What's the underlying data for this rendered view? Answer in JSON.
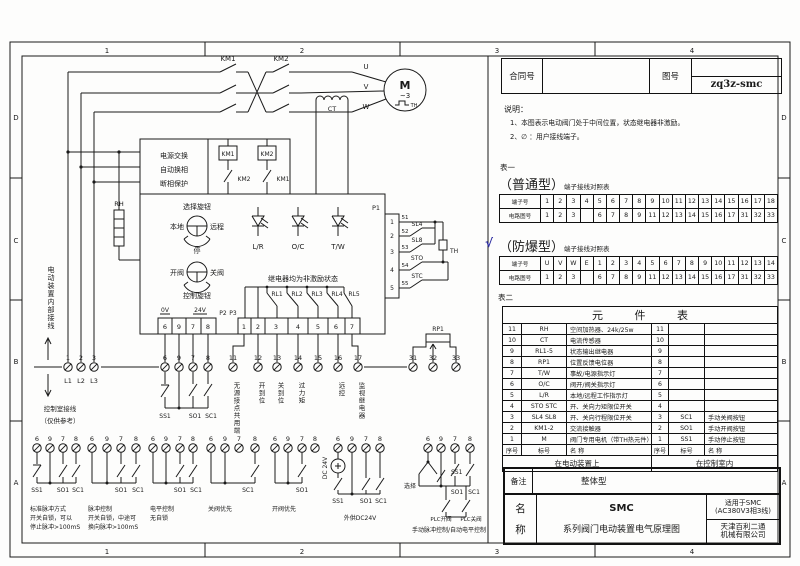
{
  "frame": {
    "top": [
      "1",
      "2",
      "3",
      "4"
    ],
    "bottom": [
      "1",
      "2",
      "3",
      "4"
    ],
    "left": [
      "D",
      "C",
      "B",
      "A"
    ],
    "right": [
      "D",
      "C",
      "B",
      "A"
    ]
  },
  "header": {
    "contract_label": "合同号",
    "drawing_label": "图号",
    "drawing_no": "zq3z-smc"
  },
  "notes": {
    "title": "说明：",
    "line1": "1、本图表示电动阀门处于中间位置，状态继电器非激励。",
    "line2": "2、∅ ：用户接线端子。"
  },
  "table1": {
    "caption": "表一",
    "putong_title": "（普通型）",
    "putong_sub": "端子接线对照表",
    "putong_rows": [
      [
        "端子号",
        "1",
        "2",
        "3",
        "4",
        "5",
        "6",
        "7",
        "8",
        "9",
        "10",
        "11",
        "12",
        "13",
        "14",
        "15",
        "16",
        "17",
        "18"
      ],
      [
        "电路图号",
        "1",
        "2",
        "3",
        "",
        "6",
        "7",
        "8",
        "9",
        "11",
        "12",
        "13",
        "14",
        "15",
        "16",
        "17",
        "31",
        "32",
        "33"
      ]
    ],
    "fangbao_check": "√",
    "fangbao_title": "（防爆型）",
    "fangbao_sub": "端子接线对照表",
    "fangbao_rows": [
      [
        "端子号",
        "U",
        "V",
        "W",
        "E",
        "1",
        "2",
        "3",
        "4",
        "5",
        "6",
        "7",
        "8",
        "9",
        "10",
        "11",
        "12",
        "13",
        "14"
      ],
      [
        "电路图号",
        "1",
        "2",
        "3",
        "",
        "6",
        "7",
        "8",
        "9",
        "11",
        "12",
        "13",
        "14",
        "15",
        "16",
        "17",
        "31",
        "32",
        "33"
      ]
    ]
  },
  "table2": {
    "caption": "表二",
    "title": "元 件 表",
    "rows": [
      [
        "11",
        "RH",
        "空间加热器、24k/25w",
        "11",
        "",
        ""
      ],
      [
        "10",
        "CT",
        "电流传感器",
        "10",
        "",
        ""
      ],
      [
        "9",
        "RL1-5",
        "状态输出继电器",
        "9",
        "",
        ""
      ],
      [
        "8",
        "RP1",
        "位置反馈电位器",
        "8",
        "",
        ""
      ],
      [
        "7",
        "T/W",
        "事故/电源指示灯",
        "7",
        "",
        ""
      ],
      [
        "6",
        "O/C",
        "阀开/阀关指示灯",
        "6",
        "",
        ""
      ],
      [
        "5",
        "L/R",
        "本地/远程工作指示灯",
        "5",
        "",
        ""
      ],
      [
        "4",
        "STO STC",
        "开、关向力矩限位开关",
        "4",
        "",
        ""
      ],
      [
        "3",
        "SL4 SL8",
        "开、关向行程限位开关",
        "3",
        "SC1",
        "手动关阀按钮"
      ],
      [
        "2",
        "KM1-2",
        "交流接触器",
        "2",
        "SO1",
        "手动开阀按钮"
      ],
      [
        "1",
        "M",
        "阀门专用电机（带TH热元件）",
        "1",
        "SS1",
        "手动停止按钮"
      ],
      [
        "序号",
        "标号",
        "名  称",
        "序号",
        "标号",
        "名  称"
      ]
    ],
    "footer_left": "在电动装置上",
    "footer_right": "在控制室内"
  },
  "remark": {
    "label": "备注",
    "value": "整体型"
  },
  "titleblock": {
    "name_label_1": "名",
    "name_label_2": "称",
    "product": "SMC",
    "product_desc": "系列阀门电动装置电气原理图",
    "apply_1": "适用于SMC",
    "apply_2": "(AC380V3相3线)",
    "company_1": "天津百利二通",
    "company_2": "机械有限公司"
  },
  "schematic": {
    "km1_top": "KM1",
    "km2_top": "KM2",
    "phase_u": "U",
    "phase_v": "V",
    "phase_w": "W",
    "motor_label": "M",
    "motor_phase": "~3",
    "motor_th": "TH",
    "ct": "CT",
    "power_box1": "电源交换",
    "power_box2": "自动换相",
    "power_box3": "断相保护",
    "km1_coil": "KM1",
    "km2_coil": "KM2",
    "km2_nc": "KM2",
    "km1_nc": "KM1",
    "rh": "RH",
    "sel_knob": "选择旋钮",
    "local": "本地",
    "remote": "远程",
    "stop": "停",
    "open": "开阀",
    "close": "关阀",
    "ctrl_knob": "控制旋钮",
    "lamps": [
      "L/R",
      "O/C",
      "T/W"
    ],
    "relay_note": "继电器均为非激励状态",
    "relays": [
      "RL1",
      "RL2",
      "RL3",
      "RL4",
      "RL5"
    ],
    "p2": "P2",
    "p3": "P3",
    "p1": "P1",
    "rp1": "RP1",
    "v0": "0V",
    "v24": "24V",
    "p2_cells": [
      "6",
      "9",
      "7",
      "8"
    ],
    "p3_cells": [
      "1",
      "2",
      "3",
      "4",
      "5",
      "6",
      "7"
    ],
    "p1_pins": [
      "1",
      "2",
      "3",
      "4",
      "5"
    ],
    "wire_nums": [
      "51",
      "52",
      "53",
      "54",
      "55"
    ],
    "sl4": "SL4",
    "sl8": "SL8",
    "sto": "STO",
    "stc": "STC",
    "th": "TH",
    "left_note_inner": "电动装置内部接线",
    "left_note_ctrl": "控制室接线",
    "left_note_ref": "（仅供参考）",
    "l_terms": [
      "1",
      "2",
      "3"
    ],
    "l_labels": [
      "L1",
      "L2",
      "L3"
    ],
    "btn_terms": [
      "6",
      "9",
      "7",
      "8"
    ],
    "btn_labels": [
      "SS1",
      "SO1",
      "SC1"
    ],
    "mid_terms": [
      "11",
      "12",
      "13",
      "14",
      "15",
      "16",
      "17"
    ],
    "mid_labels": [
      "无源接点共用端",
      "开到位",
      "关到位",
      "过力矩",
      "远控",
      "监视继电器"
    ],
    "pot_terms": [
      "31",
      "32",
      "33"
    ],
    "g_terms": [
      "6",
      "9",
      "7",
      "8"
    ],
    "g1": {
      "b1": "SS1",
      "b2": "SO1",
      "b3": "SC1",
      "c1": "标准脉冲方式",
      "c2": "开关自锁，可以",
      "c3": "停止脉冲>100mS"
    },
    "g2": {
      "b1": "SO1",
      "b2": "SC1",
      "c1": "脉冲控制",
      "c2": "开关自锁，中途可",
      "c3": "换向脉冲>100mS"
    },
    "g3": {
      "b1": "SO1",
      "b2": "SC1",
      "c1": "电平控制",
      "c2": "无自锁"
    },
    "g4": {
      "b1": "SC1",
      "c1": "关阀优先"
    },
    "g5": {
      "b1": "SO1",
      "c1": "开阀优先"
    },
    "g6": {
      "dc": "DC 24V",
      "b1": "SS1",
      "b2": "SO1",
      "b3": "SC1",
      "c1": "外供DC24V"
    },
    "g7": {
      "sel": "选择",
      "b1": "SS1",
      "b2": "SO1",
      "b3": "SC1",
      "plc1": "PLC开阀",
      "plc2": "PLC关阀",
      "c1": "手动脉冲控制/自动电平控制"
    }
  }
}
